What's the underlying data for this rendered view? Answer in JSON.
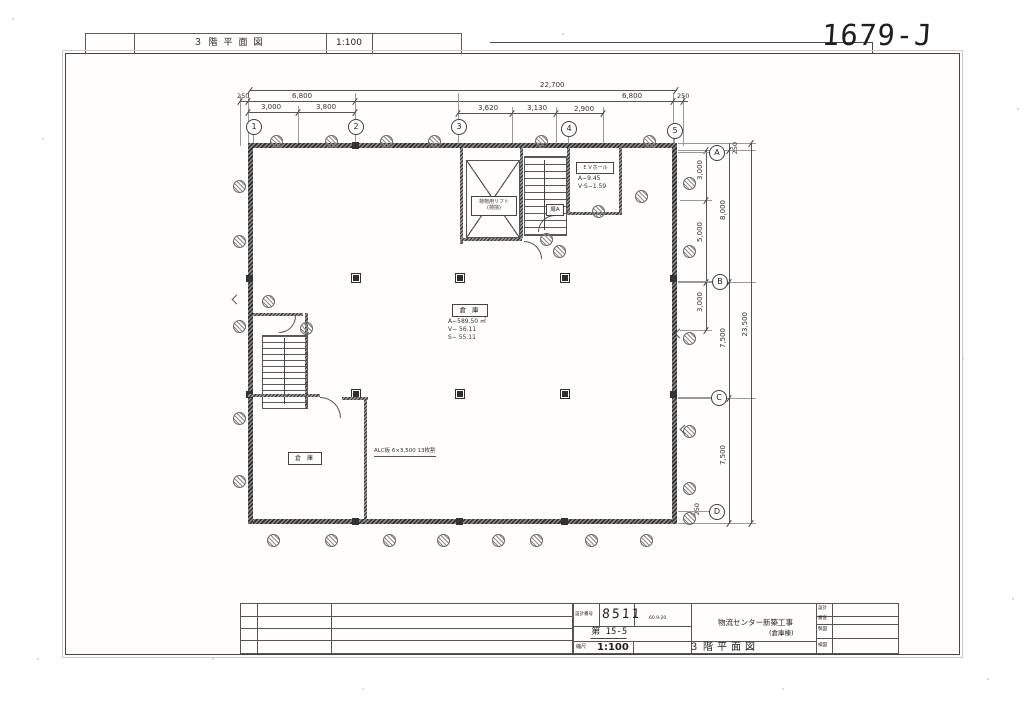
{
  "doc_number": "1679-J",
  "header_strip": {
    "title": "３階平面図",
    "scale": "1:100"
  },
  "title_block": {
    "design_no_label": "設計番号",
    "design_no": "8511",
    "design_date": "60.9.20",
    "sheet_no": "第 15-5",
    "scale_label": "縮尺",
    "scale_value": "1:100",
    "project_name": "物流センター新築工事",
    "project_sub": "(倉庫棟)",
    "drawing_title": "３階平面図",
    "approval_labels": [
      "設計",
      "審査",
      "製図",
      "検図"
    ]
  },
  "plan": {
    "grid_columns": [
      "1",
      "2",
      "3",
      "4",
      "5"
    ],
    "grid_rows": [
      "A",
      "B",
      "C",
      "D"
    ],
    "dim_overall_top": "22,700",
    "dims_top_row2": [
      "250",
      "6,800",
      "6,800",
      "250"
    ],
    "dims_top_row3": [
      "3,000",
      "3,800",
      "3,620",
      "3,130",
      "2,900"
    ],
    "dims_right": [
      "250",
      "3,000",
      "5,000",
      "8,000",
      "3,000",
      "7,500",
      "7,500",
      "23,500",
      "250"
    ],
    "labels": {
      "lift_line1": "荷物用リフト",
      "lift_line2": "(荷捌)",
      "hall_name": "ＥＶホール",
      "hall_area": "A−9.45",
      "hall_vs": "V·S−1.59",
      "center_room": "倉 庫",
      "center_area": "A−589.50 ㎡",
      "center_v": "V− 56.11",
      "center_s": "S− 55.11",
      "small_room": "倉 庫",
      "door_tag": "扉A",
      "alc_note": "ALC板 6×3,500 13枚割"
    }
  }
}
